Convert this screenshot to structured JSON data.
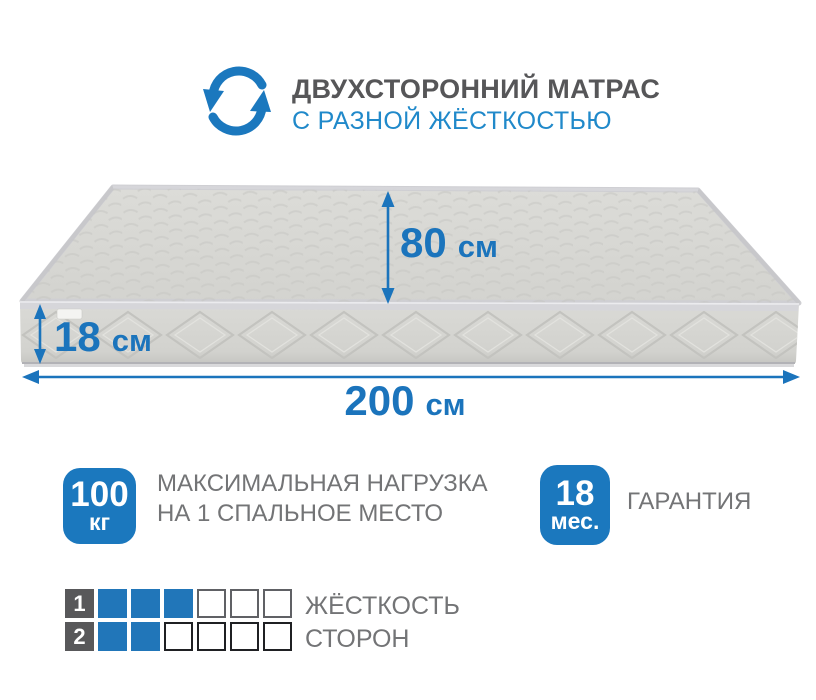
{
  "header": {
    "title": "ДВУХСТОРОННИЙ МАТРАС",
    "subtitle": "С РАЗНОЙ ЖЁСТКОСТЬЮ",
    "icon": "rotate-flip-icon"
  },
  "dimensions": {
    "top_width": {
      "value": "80",
      "unit": "см"
    },
    "height": {
      "value": "18",
      "unit": "см"
    },
    "length": {
      "value": "200",
      "unit": "см"
    }
  },
  "badges": [
    {
      "value": "100",
      "unit": "кг",
      "label_line1": "МАКСИМАЛЬНАЯ НАГРУЗКА",
      "label_line2": "НА 1 СПАЛЬНОЕ МЕСТО"
    },
    {
      "value": "18",
      "unit": "мес.",
      "label_line1": "ГАРАНТИЯ",
      "label_line2": ""
    }
  ],
  "firmness": {
    "label_line1": "ЖЁСТКОСТЬ",
    "label_line2": "СТОРОН",
    "scale_total": 6,
    "rows": [
      {
        "side": "1",
        "filled": 3,
        "total": 6
      },
      {
        "side": "2",
        "filled": 2,
        "total": 6
      }
    ]
  },
  "colors": {
    "accent_blue": "#1b74bc",
    "subtitle_blue": "#2089ca",
    "badge_blue": "#1b78be",
    "firmness_blue": "#2176b9",
    "title_gray": "#565658",
    "label_gray": "#737476",
    "number_square_gray": "#58585a",
    "mattress_gray": "#d8d8d4"
  }
}
